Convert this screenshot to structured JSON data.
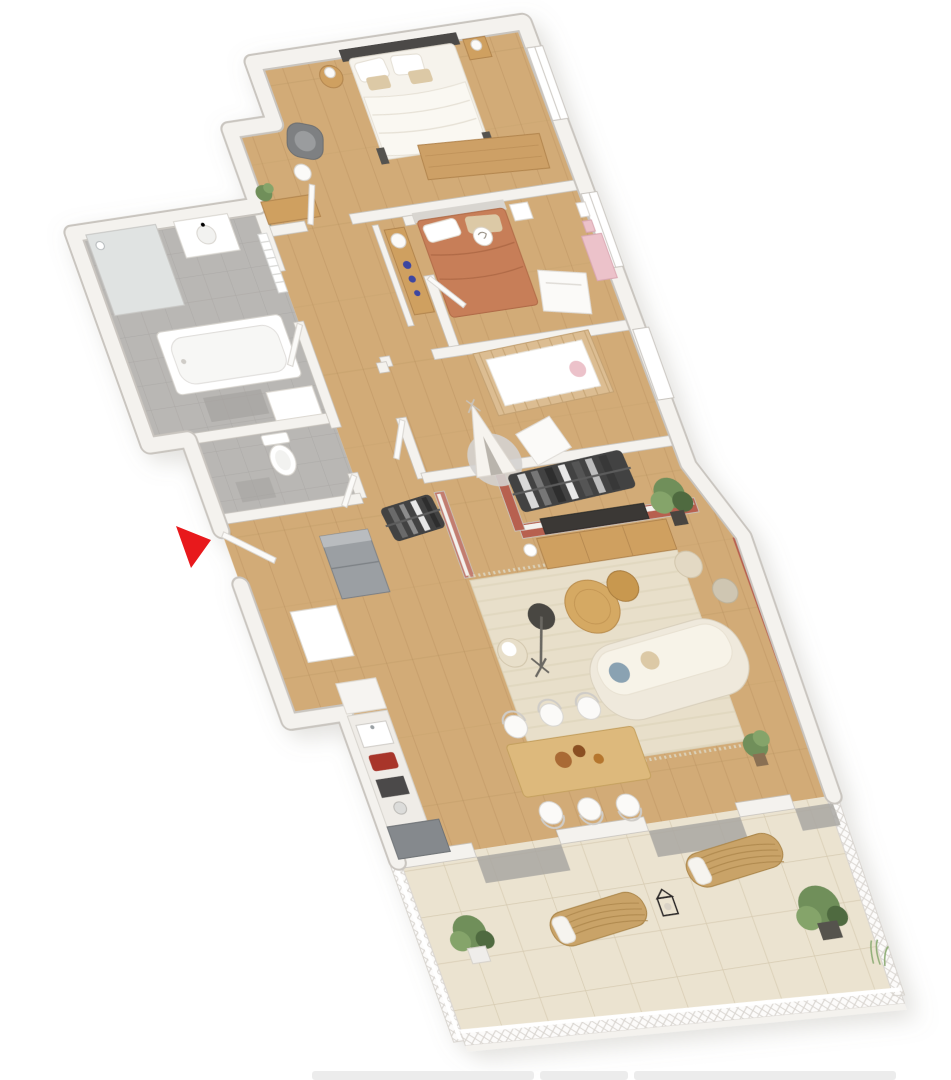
{
  "page": {
    "kind": "3d-floor-plan-render",
    "background": "#ffffff"
  },
  "colors": {
    "wallFace": "#f4f2ee",
    "wallEdge": "#c9c5bf",
    "wallShade": "#e2dfda",
    "woodFloor": "#d2ab77",
    "woodLine": "#b08a58",
    "bathFloor": "#b9b7b4",
    "bathLine": "#a5a3a0",
    "terraceTile": "#ebe3d0",
    "terraceLine": "#d6cab0",
    "matGray": "#a9a7a2",
    "oliveWall": "#8d927c",
    "mauveWall": "#a97f96",
    "terracottaWall": "#b7604f",
    "pinkWall": "#c27d6f",
    "rug": "#e8dfca",
    "rugLine": "#dbd1b8",
    "grayRug": "#d4d2cf",
    "sofaCream": "#efe9dc",
    "sofaEdge": "#d9d0bd",
    "woodFurn": "#cfa061",
    "woodFurnEdge": "#b2854e",
    "benchWood": "#cda066",
    "crib": "#dcbd92",
    "cribEdge": "#c3a172",
    "pinkKids": "#ecc2ca",
    "darkClothes": "#424242",
    "lightClothes": "#d9d9d9",
    "applianceGray": "#9b9fa3",
    "applianceDark": "#7d8185",
    "toasterRed": "#a8342c",
    "hobDark": "#4b4a48",
    "tvDark": "#3a3836",
    "arrowRed": "#e8191c",
    "plantGreen": "#6f8f5a",
    "plantLight": "#85a46b",
    "plantDark": "#4f6b3f",
    "potDark": "#4a453f",
    "potLight": "#efedea",
    "lampDark": "#4a4743",
    "blueVase": "#3c46a0",
    "blueCushion": "#8aa2b2",
    "beigeCushion": "#dcc9a6",
    "headboardDark": "#4b4846",
    "terracottaBed": "#c77e58",
    "terracottaBedFold": "#b06b47",
    "white": "#ffffff",
    "offWhite": "#fbfaf8",
    "glass": "#cfd6d9",
    "latticeLine": "#d8d4cf",
    "grayChair": "#7e8082",
    "grayChairLight": "#9a9c9e",
    "thumbGray": "#ececec"
  },
  "entrance_marker": {
    "shape": "red-triangle-arrow",
    "points": "176,526 211,540 191,568"
  },
  "rooms": [
    {
      "id": "master-bedroom",
      "accent_wall": "olive",
      "floor": "wood",
      "furniture": [
        "double-bed",
        "dark-headboard",
        "pillows",
        "nightstand-left",
        "nightstand-right",
        "table-lamps",
        "storage-bench",
        "gray-armchair",
        "floor-lamp",
        "wood-sideboard",
        "potted-plant"
      ]
    },
    {
      "id": "bedroom-2",
      "accent_wall": "none",
      "floor": "wood",
      "furniture": [
        "double-bed-terracotta",
        "white-headboard",
        "white-desk-panel",
        "bedside-table",
        "pink-kids-shelf",
        "wall-posters"
      ]
    },
    {
      "id": "nursery",
      "accent_wall": "mauve",
      "floor": "wood",
      "furniture": [
        "wooden-crib",
        "teepee-tent",
        "round-gray-rug",
        "changing-table"
      ]
    },
    {
      "id": "bathroom",
      "accent_wall": "none",
      "floor": "gray-tile",
      "furniture": [
        "bathtub",
        "walk-in-shower",
        "washbasin",
        "towel-radiator",
        "vanity-cabinet",
        "bath-mat"
      ]
    },
    {
      "id": "wc",
      "accent_wall": "none",
      "floor": "gray-tile",
      "furniture": [
        "toilet",
        "mat"
      ]
    },
    {
      "id": "hallway",
      "accent_wall": "none",
      "floor": "wood",
      "furniture": [
        "console-table",
        "white-lamp",
        "blue-vases",
        "interior-doors"
      ]
    },
    {
      "id": "entry",
      "accent_wall": "pink",
      "floor": "wood",
      "furniture": [
        "entry-door",
        "fridge",
        "shoe-cabinet",
        "clothes-rack"
      ]
    },
    {
      "id": "living-room",
      "accent_wall": "terracotta",
      "floor": "wood",
      "furniture": [
        "tv-wall",
        "tv",
        "tv-stand",
        "large-rug",
        "curved-sofa",
        "coffee-table-large",
        "coffee-table-small",
        "floor-lamp-dark",
        "poufs",
        "potted-plants",
        "dressing-clothes-rack"
      ]
    },
    {
      "id": "kitchen",
      "accent_wall": "none",
      "floor": "wood",
      "furniture": [
        "counter-run",
        "sink",
        "red-toaster",
        "cooktop",
        "canister",
        "tall-dark-unit",
        "white-cabinet"
      ]
    },
    {
      "id": "dining-area",
      "accent_wall": "none",
      "floor": "wood",
      "furniture": [
        "wood-dining-table",
        "six-white-chairs",
        "wooden-bowls"
      ]
    },
    {
      "id": "terrace",
      "accent_wall": "none",
      "floor": "beige-tile",
      "furniture": [
        "lattice-railing",
        "sun-lounger-left",
        "sun-lounger-right",
        "lantern",
        "potted-shrubs",
        "door-mats"
      ]
    }
  ],
  "footer_thumbnails": {
    "count": 3
  }
}
